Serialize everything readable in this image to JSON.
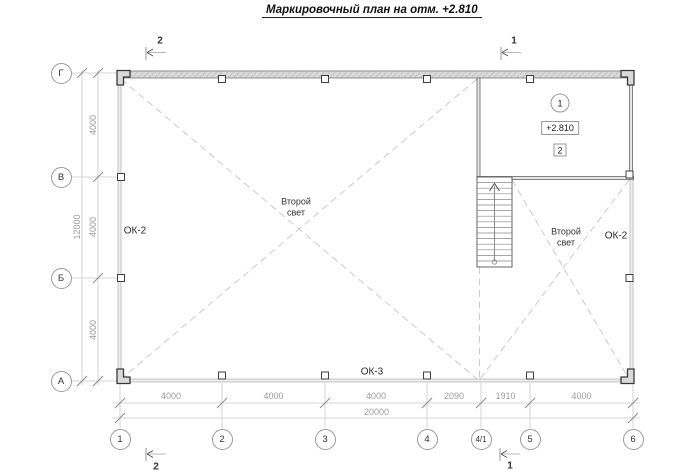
{
  "title": "Маркировочный план на отм. +2.810",
  "section_markers": {
    "top_left": "2",
    "top_right": "1",
    "bottom_left": "2",
    "bottom_right": "1"
  },
  "axes": {
    "rows": [
      "Г",
      "В",
      "Б",
      "А"
    ],
    "cols": [
      "1",
      "2",
      "3",
      "4",
      "4/1",
      "5",
      "6"
    ]
  },
  "dims": {
    "left": {
      "segments": [
        "4000",
        "4000",
        "4000"
      ],
      "total": "12000"
    },
    "bottom": {
      "segments": [
        "4000",
        "4000",
        "4000",
        "2090",
        "1910",
        "4000"
      ],
      "total": "20000"
    }
  },
  "labels": {
    "ok2_left": "ОК-2",
    "ok2_right": "ОК-2",
    "ok3": "ОК-3",
    "void_center_line1": "Второй",
    "void_center_line2": "свет",
    "void_right_line1": "Второй",
    "void_right_line2": "свет"
  },
  "room_tags": {
    "axis_tag": "1",
    "elevation": "+2.810",
    "number_tag": "2"
  },
  "colors": {
    "wall_fill": "#d9d9d9",
    "line_dark": "#3a3a3a",
    "dim_gray": "#9c9c9c",
    "dash_gray": "#c6c6c6",
    "glazing_gray": "#b0b0b0"
  }
}
